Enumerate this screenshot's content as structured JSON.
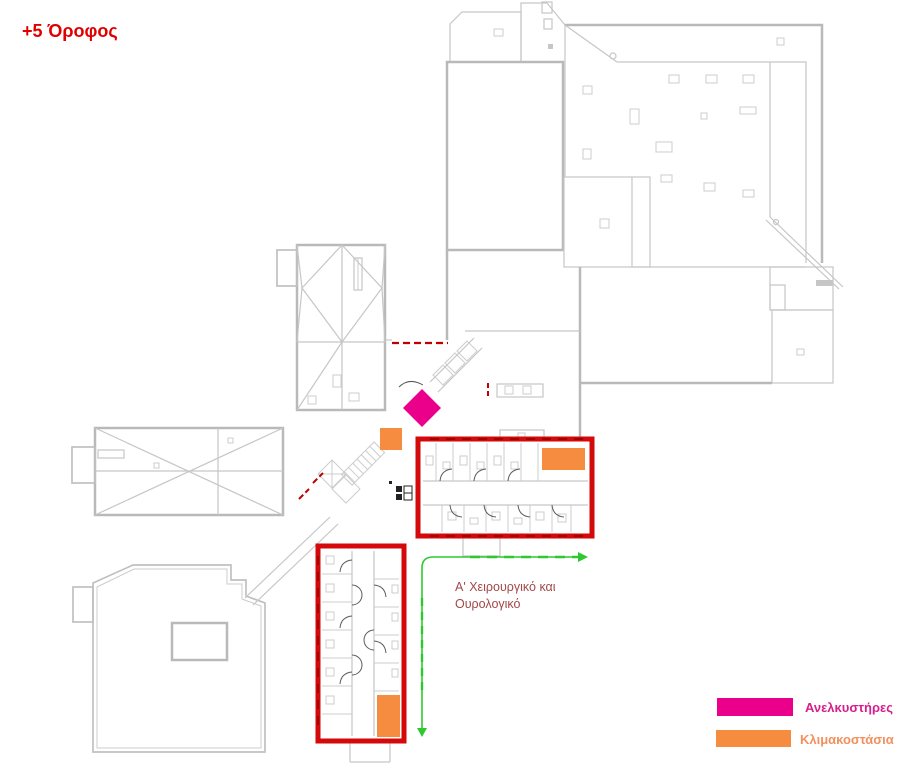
{
  "title": {
    "text": "+5 Όροφος",
    "color": "#e00000"
  },
  "area_label": {
    "line1": "Α' Χειρουργικό και",
    "line2": "Ουρολογικό",
    "color": "#a34848"
  },
  "legend": {
    "items": [
      {
        "id": "elevators",
        "label": "Ανελκυστήρες",
        "swatch_color": "#eb008b",
        "label_color": "#d61e8c"
      },
      {
        "id": "staircases",
        "label": "Κλιμακοστάσια",
        "swatch_color": "#f68c3f",
        "label_color": "#f0915f"
      }
    ]
  },
  "colors": {
    "elevator_marker": "#eb008b",
    "staircase_marker": "#f68c3f",
    "zone_outline": "#d40a0a",
    "wall_accent_red": "#c00000",
    "zone_dash_red": "#a00000",
    "route_green": "#2fc92f",
    "walls_gray": "#c6c6c6"
  }
}
